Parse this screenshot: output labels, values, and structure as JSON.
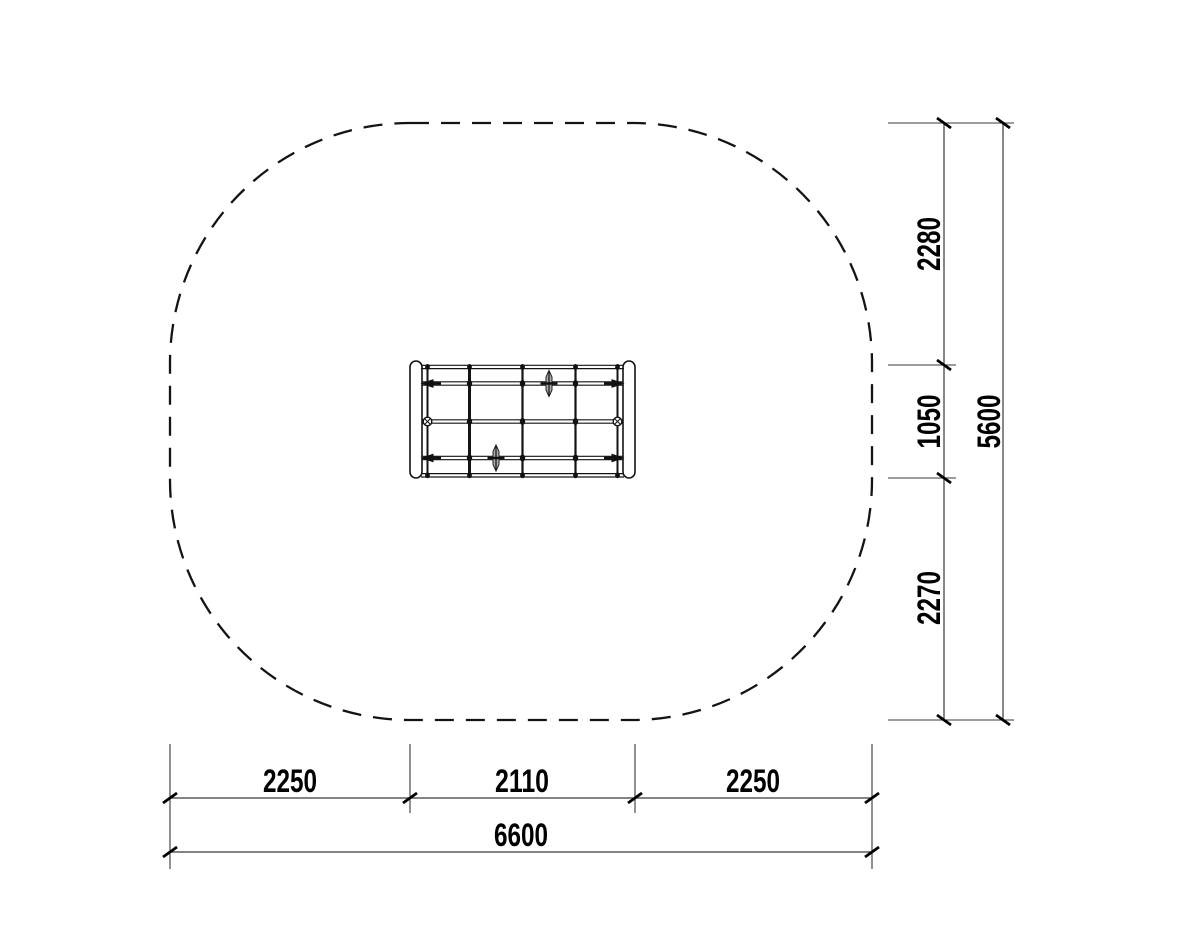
{
  "drawing": {
    "type": "plan-view-technical-drawing",
    "background_color": "#ffffff",
    "ink_color": "#141414",
    "dim_line_color": "#3a3a3a",
    "tick_color": "#000000",
    "anchor_fill_color": "#aaaaaa"
  },
  "dimensions": {
    "bottom": {
      "segments": [
        "2250",
        "2110",
        "2250"
      ],
      "total": "6600"
    },
    "right": {
      "segments": [
        "2280",
        "1050",
        "2270"
      ],
      "total": "5600"
    }
  }
}
